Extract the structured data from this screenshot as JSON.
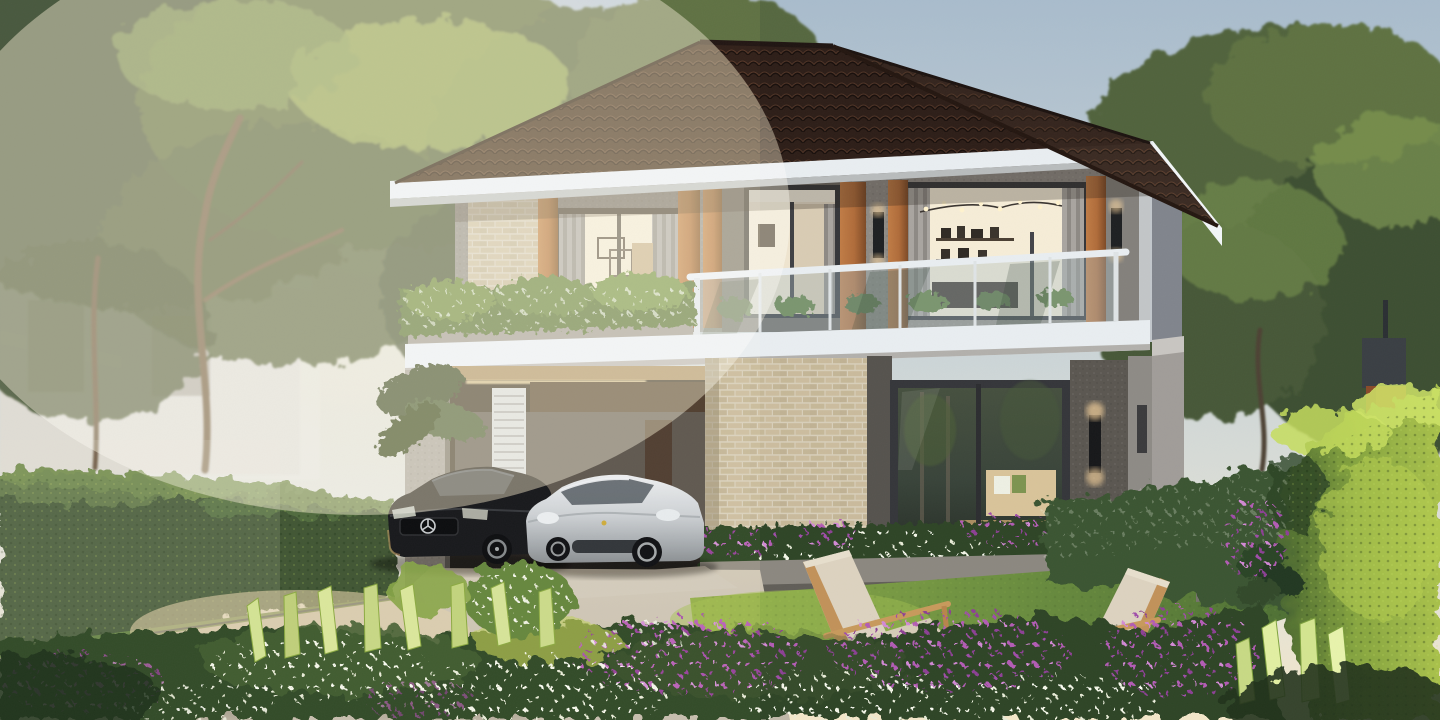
{
  "scene": {
    "setting": "Photorealistic architectural rendering of a modern two-story detached house at golden hour, with tiled hip roof, timber pillars, glass balcony, carport with two parked cars, lawn with two wooden armchairs, flower beds, hedges and background trees",
    "elements": [
      "sky",
      "sun glow",
      "background trees",
      "neighbor house",
      "main house",
      "hip roof",
      "white fascia",
      "timber pillars",
      "second-floor windows",
      "glass balcony railing",
      "balcony planter shrubs",
      "carport",
      "white louver door",
      "black coupe",
      "silver sports coupe",
      "driveway",
      "brick wall",
      "living-room window",
      "wall sconces",
      "lawn",
      "two wooden armchairs",
      "flower planter",
      "purple flowers",
      "white flowers",
      "variegated leaf plants",
      "left hedge",
      "right sunlit hedge",
      "white picket fence",
      "corten signpost"
    ]
  },
  "palette": {
    "sky_top": "#a9bccd",
    "sky_mid": "#cdd6d8",
    "sky_glow": "#f3e7c9",
    "roof_dark": "#31221c",
    "fascia_white": "#e9eef1",
    "wall_grey": "#8f8b85",
    "wall_dark": "#5b5751",
    "brick_tan": "#c9bb9e",
    "wood_pillar": "#b06c3a",
    "glass_warm": "#f4e9ce",
    "frame_dark": "#35363a",
    "hedge_shade": "#3a4f32",
    "hedge_sun": "#aac24c",
    "lawn_green": "#6d9040",
    "bed_green": "#2e4426",
    "flower_purple": "#b35cb5",
    "flower_white": "#f3f6e8",
    "driveway_grey": "#c0b8a9",
    "car_black": "#16171b",
    "car_silver": "#c9ced3",
    "chair_wood": "#c99e63",
    "cushion_beige": "#ddd3c0",
    "corten_rust": "#a85c34",
    "sconce_glow": "#ffd9a0"
  },
  "vehicles": [
    {
      "name": "black-coupe",
      "color": "#16171b",
      "badge": "three-pointed-star"
    },
    {
      "name": "silver-sports-coupe",
      "color": "#c9ced3"
    }
  ],
  "furniture": {
    "armchair_count": 2,
    "frame": "light wood",
    "cushion": "beige"
  },
  "lighting": {
    "sun_direction": "left",
    "interior_lights_on": true,
    "wall_sconces_lit": true
  }
}
